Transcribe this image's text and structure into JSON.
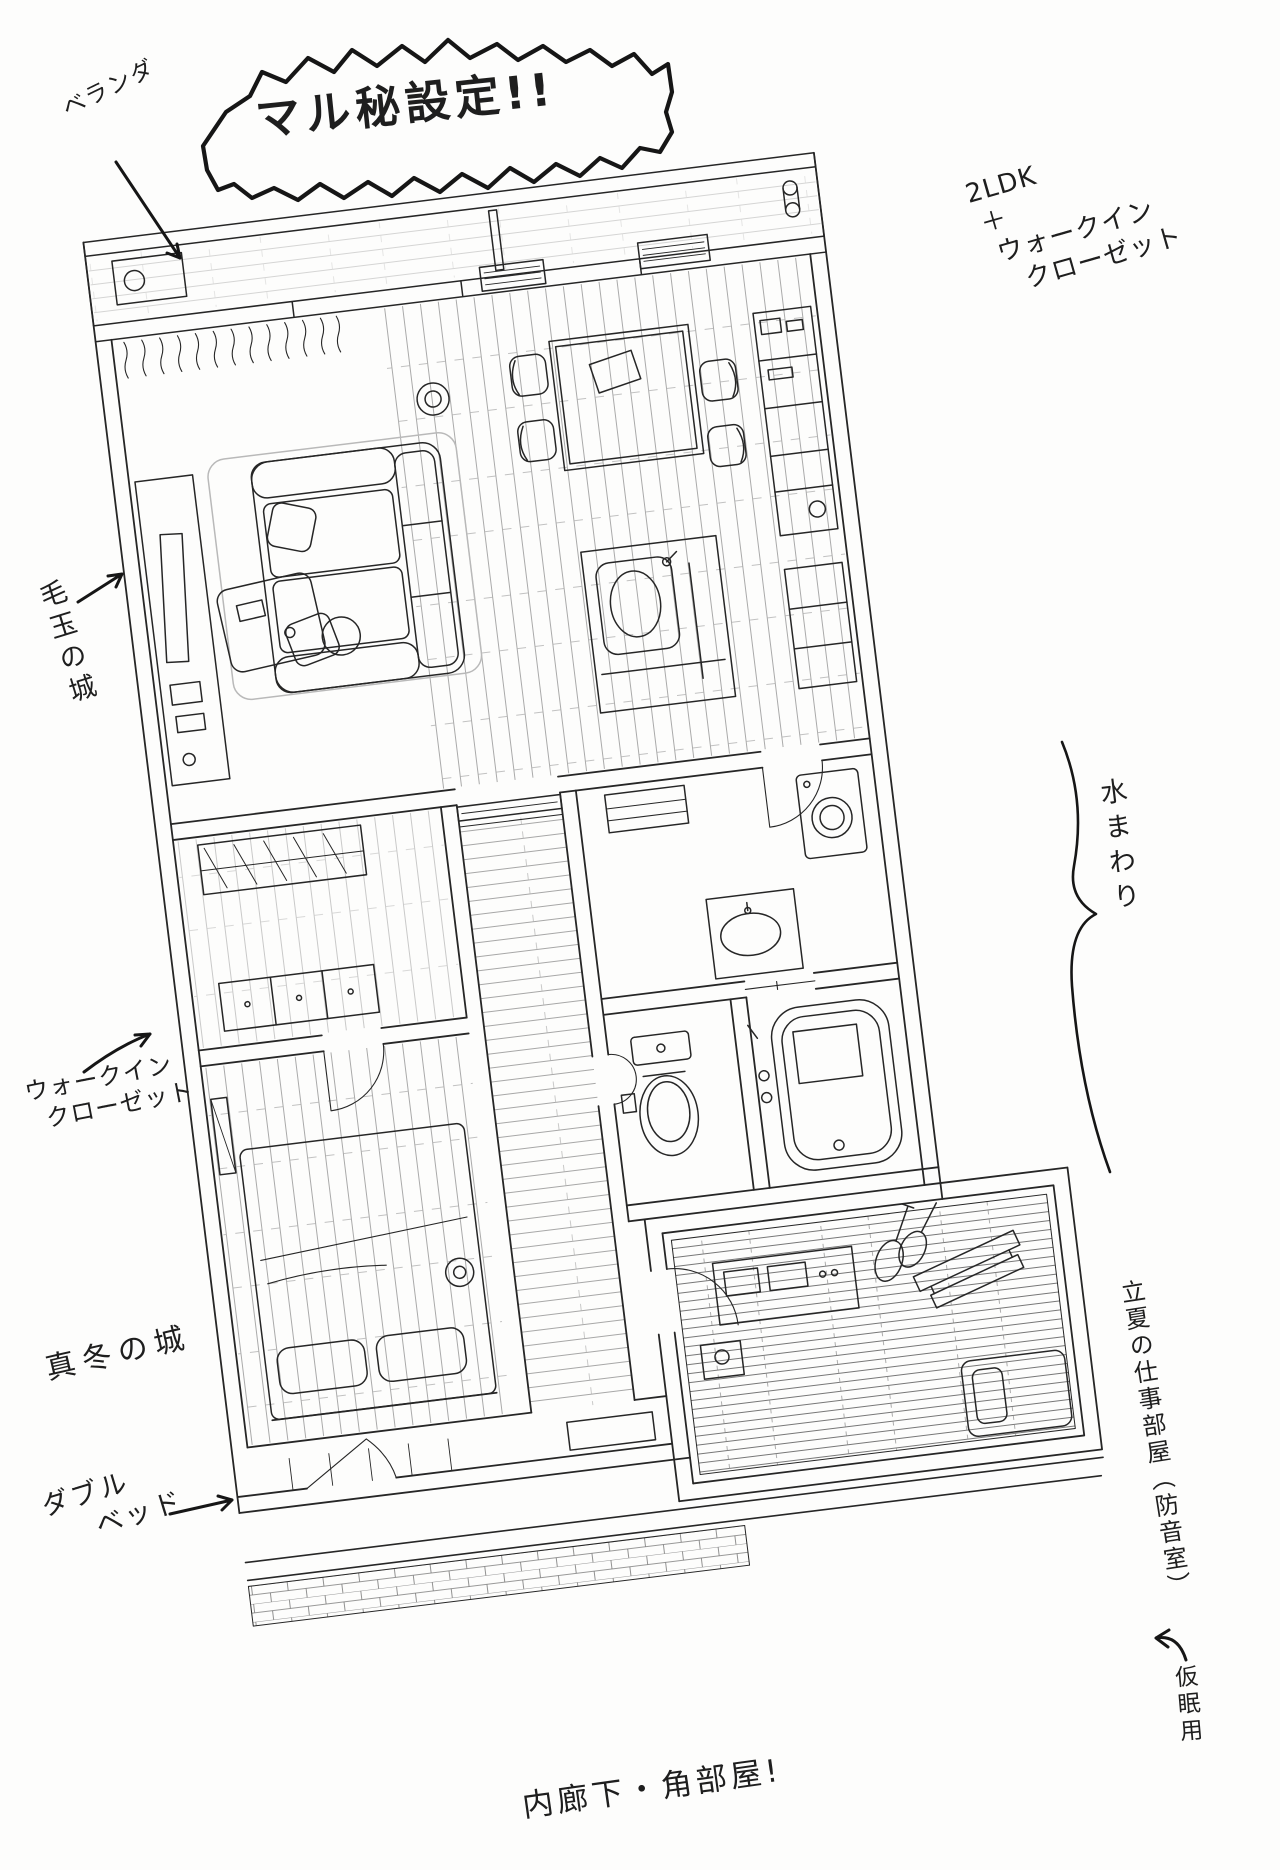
{
  "style": {
    "ink": "#262626",
    "paper": "#fdfdfc"
  },
  "title_bubble": {
    "text": "マル秘設定!!"
  },
  "annotations": {
    "veranda": {
      "label": "ベランダ"
    },
    "layout_spec": {
      "line1": "2LDK",
      "line2": "＋",
      "line3": "ウォークイン",
      "line4": "クローゼット"
    },
    "kedama_castle": {
      "label": "毛玉の城"
    },
    "water_area": {
      "label": "水まわり"
    },
    "walk_in_closet": {
      "line1": "ウォークイン",
      "line2": "クローゼット"
    },
    "mafuyu_castle": {
      "label": "真冬の城"
    },
    "rikka_workroom": {
      "label": "立夏の仕事部屋（防音室）"
    },
    "double_bed": {
      "line1": "ダブル",
      "line2": "ベッド"
    },
    "nap_use": {
      "label": "仮眠用"
    },
    "corner_room": {
      "label": "内廊下・角部屋!"
    }
  }
}
